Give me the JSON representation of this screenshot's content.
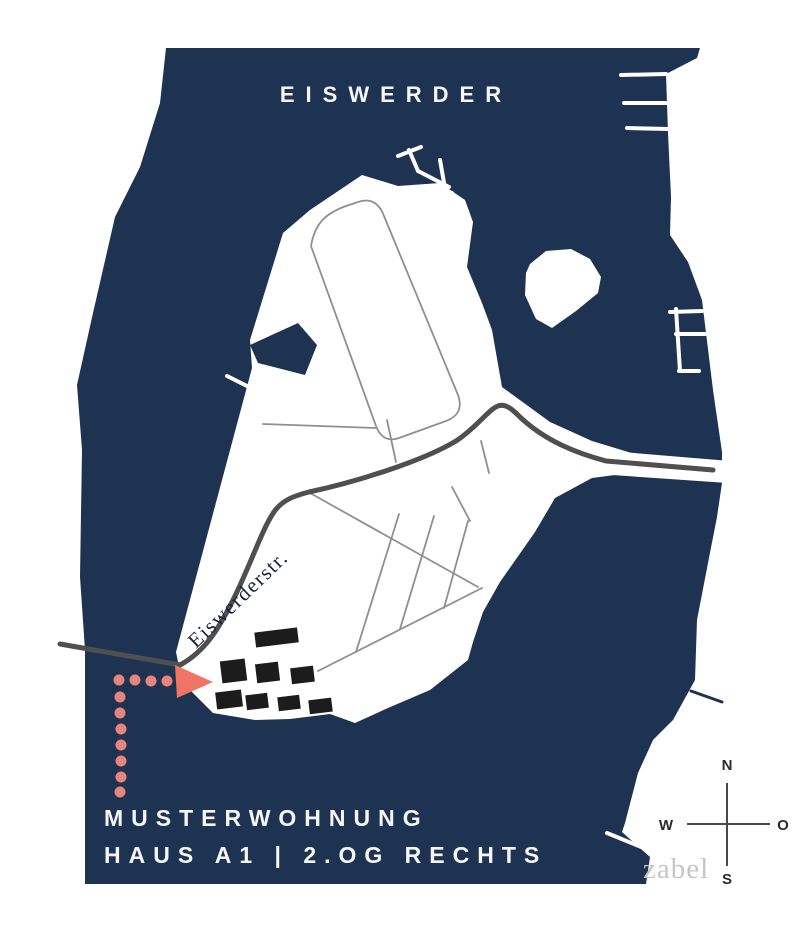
{
  "title": "EISWERDER",
  "street_label": "Eiswerderstr.",
  "caption": {
    "line1": "MUSTERWOHNUNG",
    "line2": "HAUS A1 | 2.OG RECHTS"
  },
  "compass": {
    "north": "N",
    "east": "O",
    "south": "S",
    "west": "W"
  },
  "watermark": "zabel",
  "colors": {
    "water": "#1e3351",
    "land": "#ffffff",
    "road": "#4f4f4f",
    "street": "#8f8f8f",
    "building": "#1c1c1c",
    "accent_arrow": "#f07565",
    "accent_dots": "#e8837d",
    "watermark_gray": "#c5c5c5",
    "compass_gray": "#4a4a4a"
  }
}
